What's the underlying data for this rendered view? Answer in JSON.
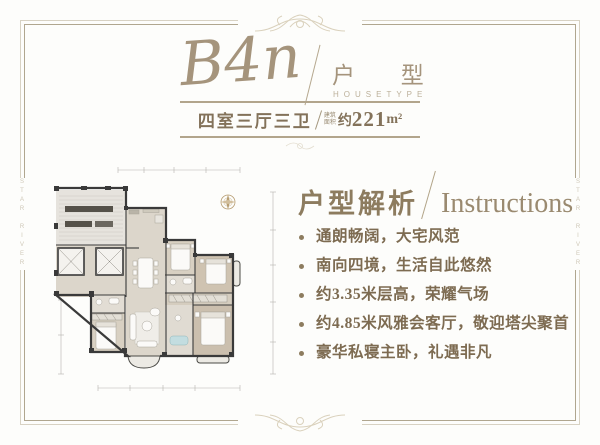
{
  "watermark": {
    "left": "STAR RIVER",
    "right": "STAR RIVER"
  },
  "header": {
    "unit_code": "B4n",
    "category_cn": "户 型",
    "category_en": "HOUSETYPE",
    "spec": "四室三厅三卫",
    "area_prefix_line1": "建筑",
    "area_prefix_line2": "面积",
    "area_about": "约",
    "area_value": "221",
    "area_unit": "m²"
  },
  "instructions": {
    "title_cn": "户型解析",
    "title_en": "Instructions",
    "items": [
      "通朗畅阔，大宅风范",
      "南向四境，生活自此悠然",
      "约3.35米层高，荣耀气场",
      "约4.85米风雅会客厅，敬迎塔尖聚首",
      "豪华私寝主卧，礼遇非凡"
    ]
  },
  "floor_plan": {
    "compass": "north-compass",
    "colors": {
      "wall": "#3a3a3a",
      "floor_light": "#dcd6cb",
      "floor_bedroom": "#d8d0c2",
      "floor_master": "#cbbfae",
      "tub": "#c3dde0",
      "dimension_line": "#b5b3ae",
      "accent_gold": "#a5947c"
    }
  }
}
